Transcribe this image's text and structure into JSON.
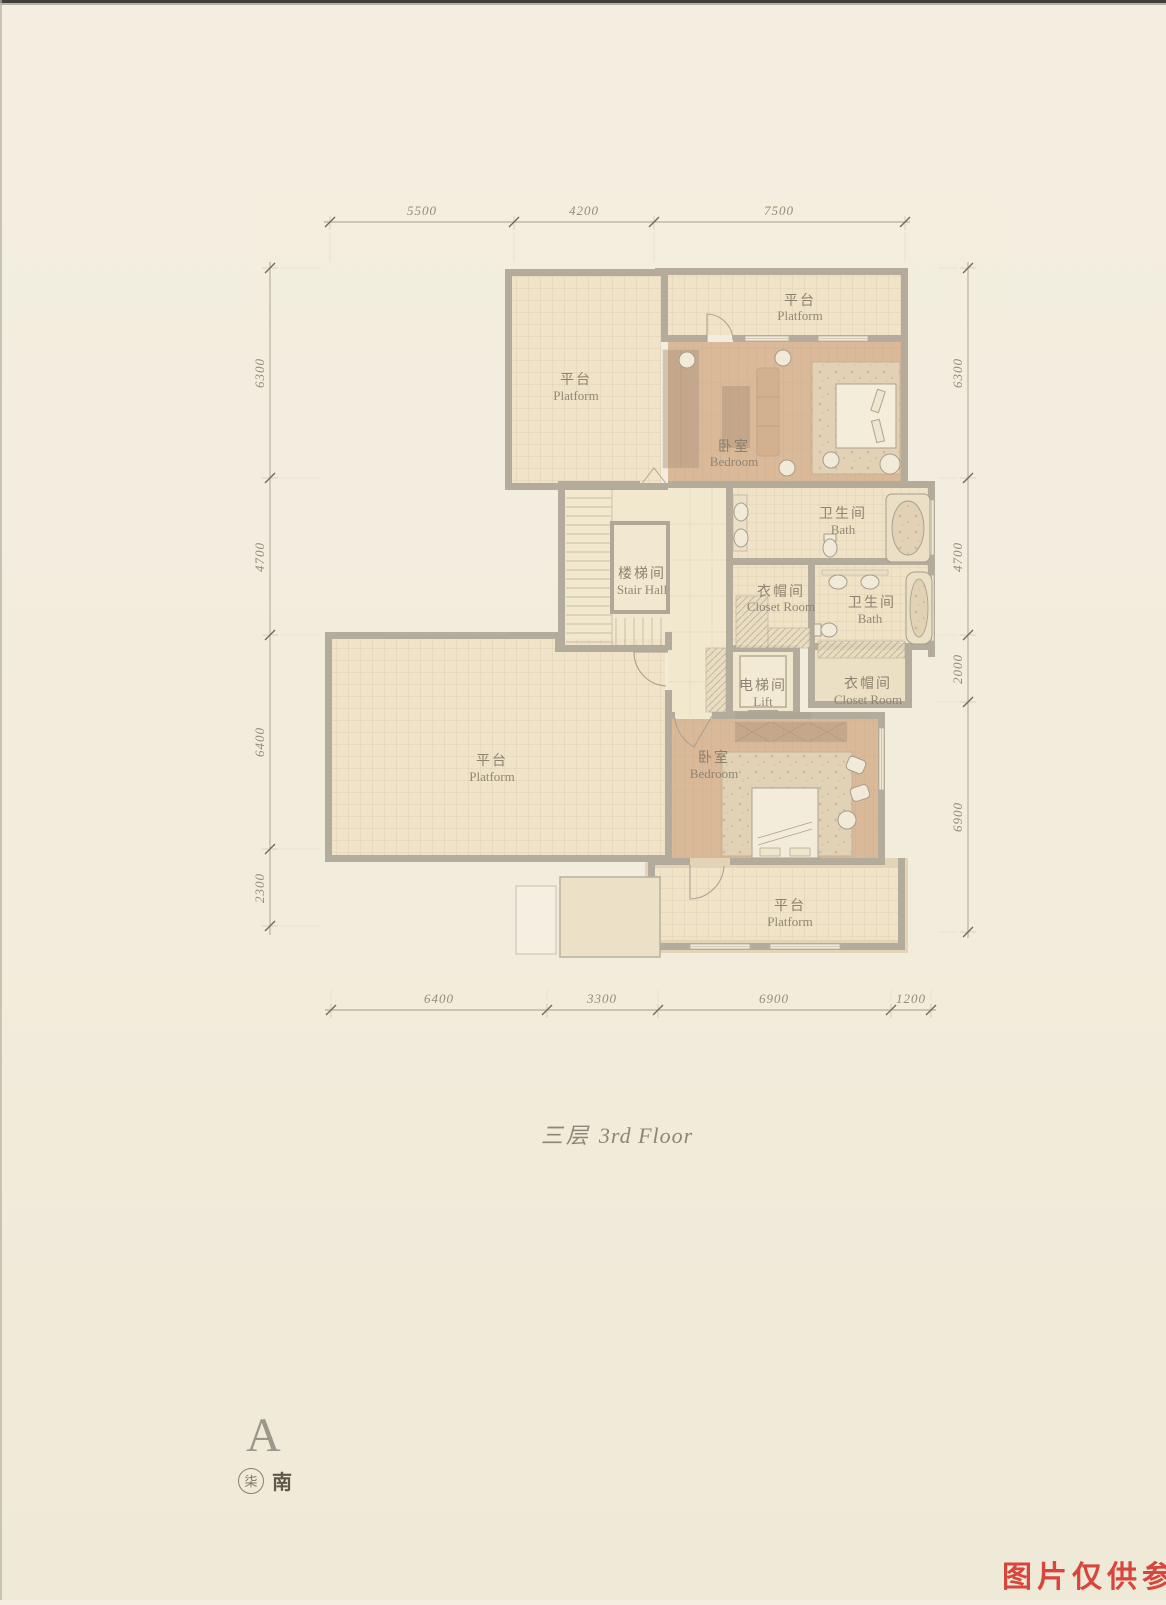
{
  "document": {
    "floor_title_zh": "三层",
    "floor_title_en": "3rd Floor",
    "watermark": {
      "text": "图片仅供参考",
      "color": "#d8453c"
    },
    "compass": {
      "letter": "A",
      "seal_char": "柒",
      "direction_label": "南"
    }
  },
  "rooms": {
    "platform_top_left": {
      "zh": "平台",
      "en": "Platform"
    },
    "platform_top": {
      "zh": "平台",
      "en": "Platform"
    },
    "bedroom_upper": {
      "zh": "卧室",
      "en": "Bedroom"
    },
    "bath_upper": {
      "zh": "卫生间",
      "en": "Bath"
    },
    "stair_hall": {
      "zh": "楼梯间",
      "en": "Stair Hall"
    },
    "closet_mid": {
      "zh": "衣帽间",
      "en": "Closet Room"
    },
    "bath_mid": {
      "zh": "卫生间",
      "en": "Bath"
    },
    "lift": {
      "zh": "电梯间",
      "en": "Lift"
    },
    "closet_right": {
      "zh": "衣帽间",
      "en": "Closet Room"
    },
    "platform_left": {
      "zh": "平台",
      "en": "Platform"
    },
    "bedroom_lower": {
      "zh": "卧室",
      "en": "Bedroom"
    },
    "platform_bottom": {
      "zh": "平台",
      "en": "Platform"
    }
  },
  "dimensions": {
    "top": [
      "5500",
      "4200",
      "7500"
    ],
    "left": [
      "6300",
      "4700",
      "6400",
      "2300"
    ],
    "right": [
      "6300",
      "4700",
      "2000",
      "6900"
    ],
    "bottom": [
      "6400",
      "3300",
      "6900",
      "1200"
    ]
  },
  "colors": {
    "paper": "#f2edde",
    "wall": "#938a7a",
    "wood_floor": "#cf9f76",
    "tile_floor": "#efdfbd",
    "dimension_text": "#958c79",
    "label_text": "#857b6a",
    "watermark_red": "#d8453c"
  }
}
